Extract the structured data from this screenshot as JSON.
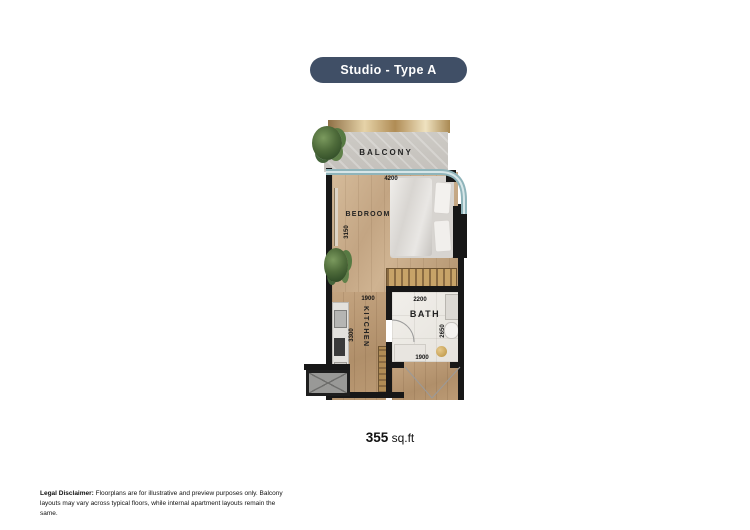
{
  "title": "Studio - Type A",
  "plan": {
    "rooms": {
      "balcony": "BALCONY",
      "bedroom": "BEDROOM",
      "kitchen": "KITCHEN",
      "bath": "BATH"
    },
    "dimensions": {
      "bedroom_width": "4200",
      "bedroom_depth": "3150",
      "kitchen_width": "1900",
      "kitchen_depth": "3300",
      "bath_width": "2200",
      "bath_depth": "2650",
      "bath_bottom": "1900"
    }
  },
  "area": {
    "value": "355",
    "unit": "sq.ft"
  },
  "disclaimer": {
    "label": "Legal Disclaimer:",
    "text": " Floorplans are for illustrative and preview purposes only. Balcony layouts may vary across typical floors, while internal apartment layouts remain the same."
  },
  "colors": {
    "title_bg": "#404f66",
    "wall": "#171717",
    "wood": "#c3a583",
    "glass_rail": "#8fb4ba",
    "gold_accent": "#b08c55",
    "bath_tile": "#eceae5"
  }
}
